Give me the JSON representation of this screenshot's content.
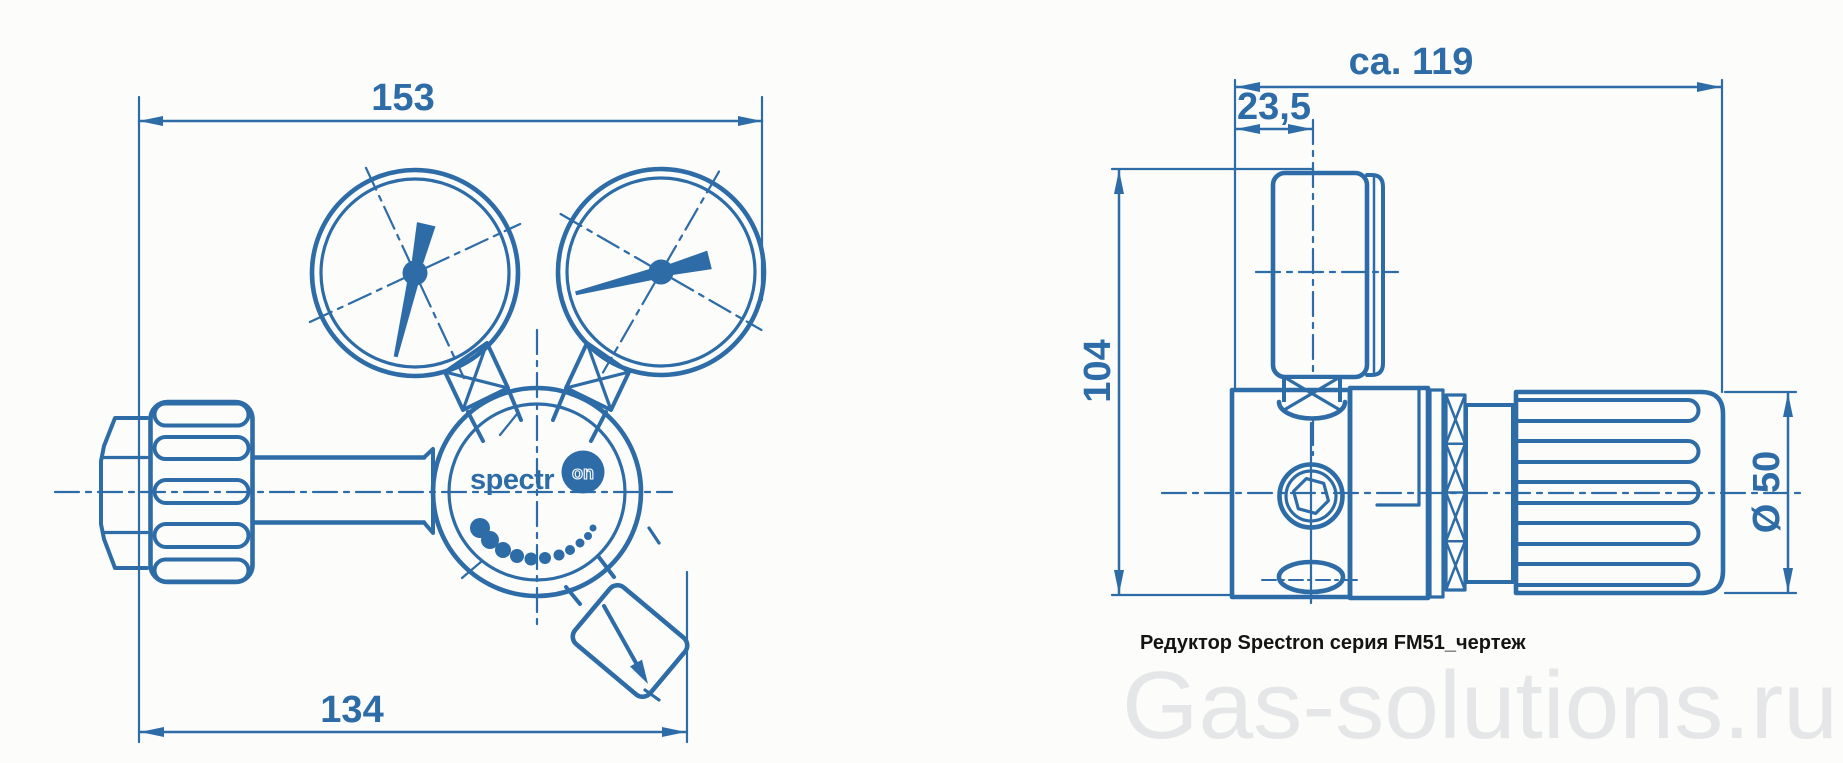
{
  "drawing": {
    "caption": "Редуктор Spectron серия FM51_чертеж",
    "watermark": "Gas-solutions.ru",
    "logo": {
      "prefix": "spectr",
      "suffix": "on"
    },
    "front_view": {
      "dim_top": "153",
      "dim_bottom": "134"
    },
    "side_view": {
      "dim_overall": "ca. 119",
      "dim_offset": "23,5",
      "dim_height": "104",
      "dim_diameter": "Ø 50"
    },
    "colors": {
      "line": "#2d6ca7",
      "caption": "#141414",
      "watermark": "#e4e6e8",
      "background": "#fcfcfa"
    }
  }
}
